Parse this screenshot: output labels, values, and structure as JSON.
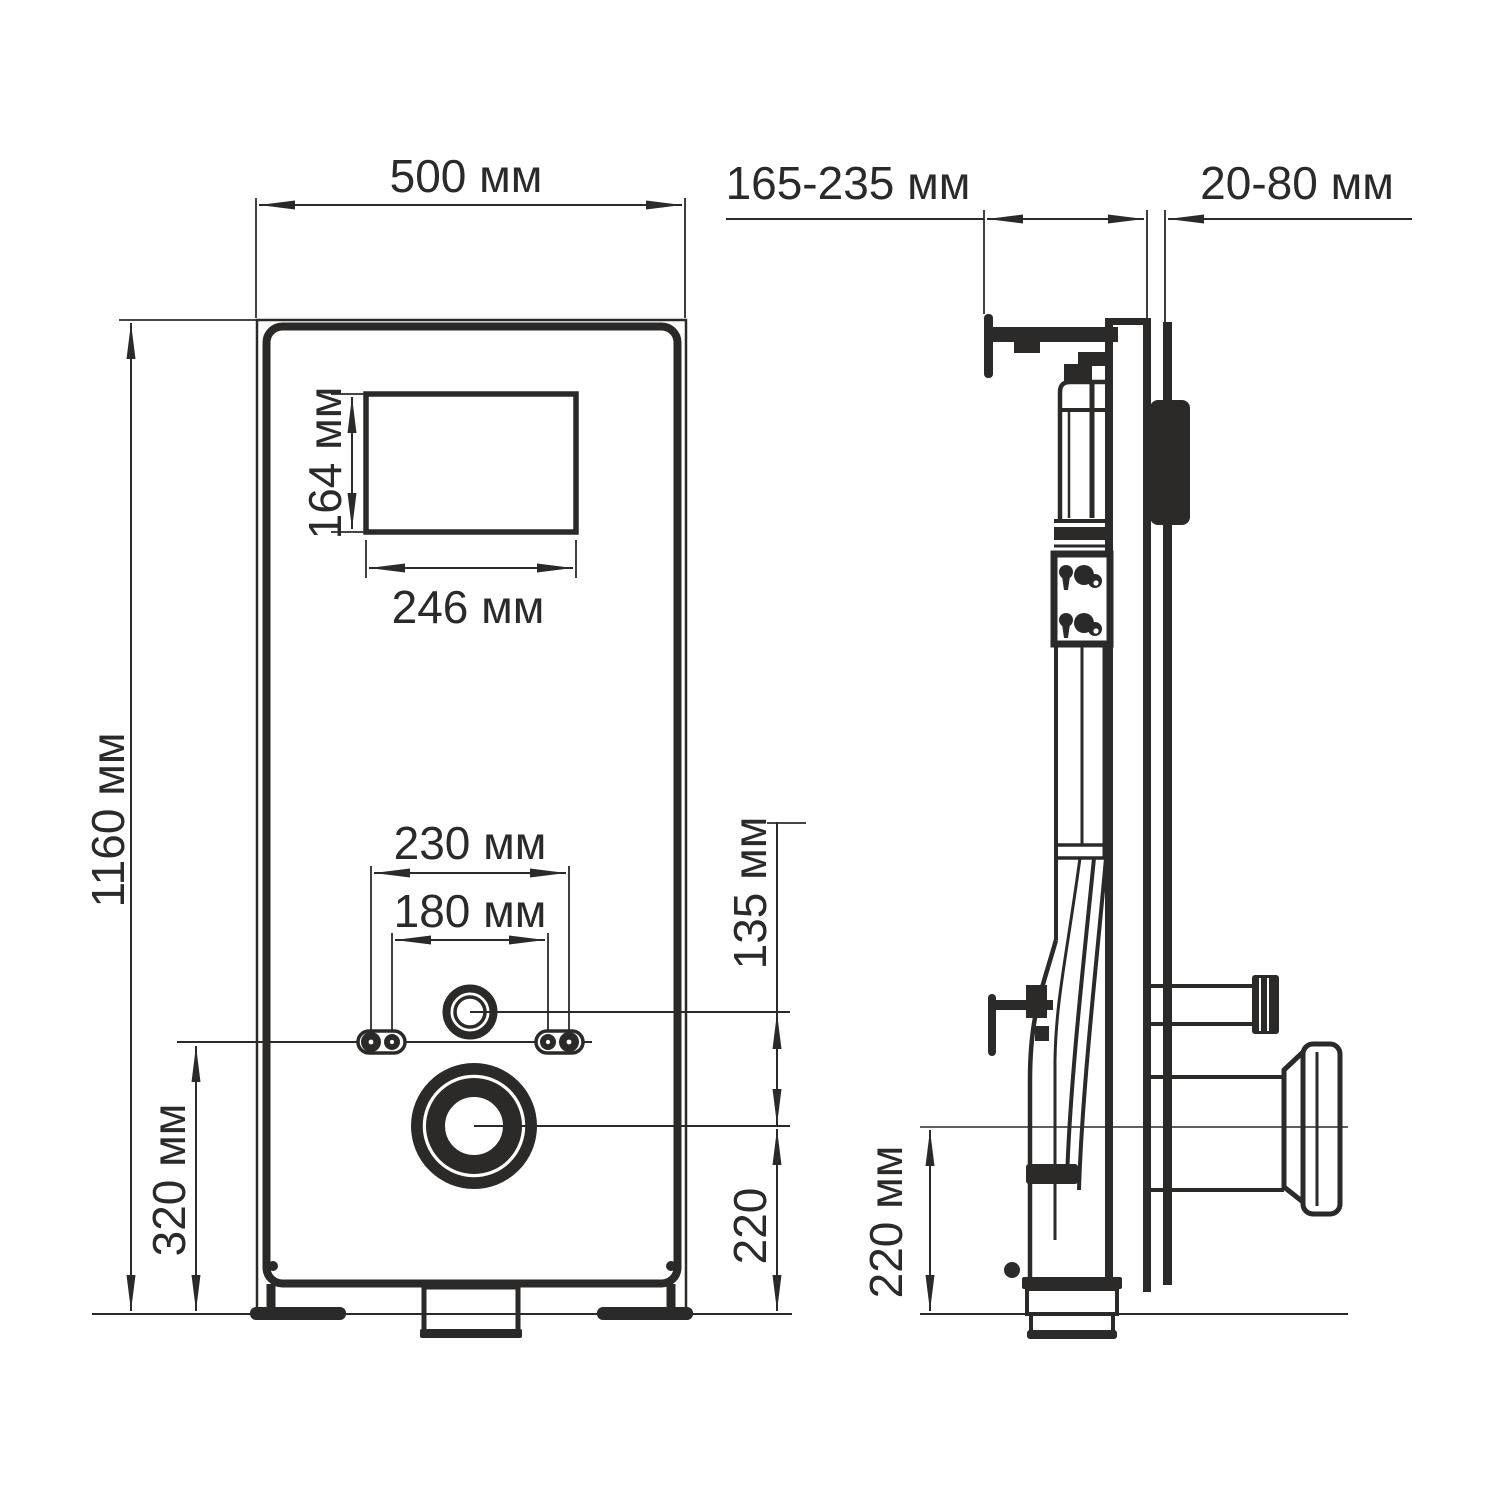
{
  "drawing": {
    "type": "installation frame technical drawing, front and side views",
    "unit": "мм",
    "line_color": "#2b2a29",
    "background_color": "#ffffff",
    "front_view": {
      "width": "500 мм",
      "height": "1160 мм",
      "service_window_height": "164 мм",
      "service_window_width": "246 мм",
      "bolt_spacing_outer": "230 мм",
      "bolt_spacing_inner": "180 мм",
      "inlet_to_outlet_offset": "135 мм",
      "outlet_height": "220",
      "bolt_line_height": "320 мм"
    },
    "side_view": {
      "depth_range": "165-235 мм",
      "wall_offset_range": "20-80 мм",
      "outlet_height": "220 мм"
    }
  }
}
